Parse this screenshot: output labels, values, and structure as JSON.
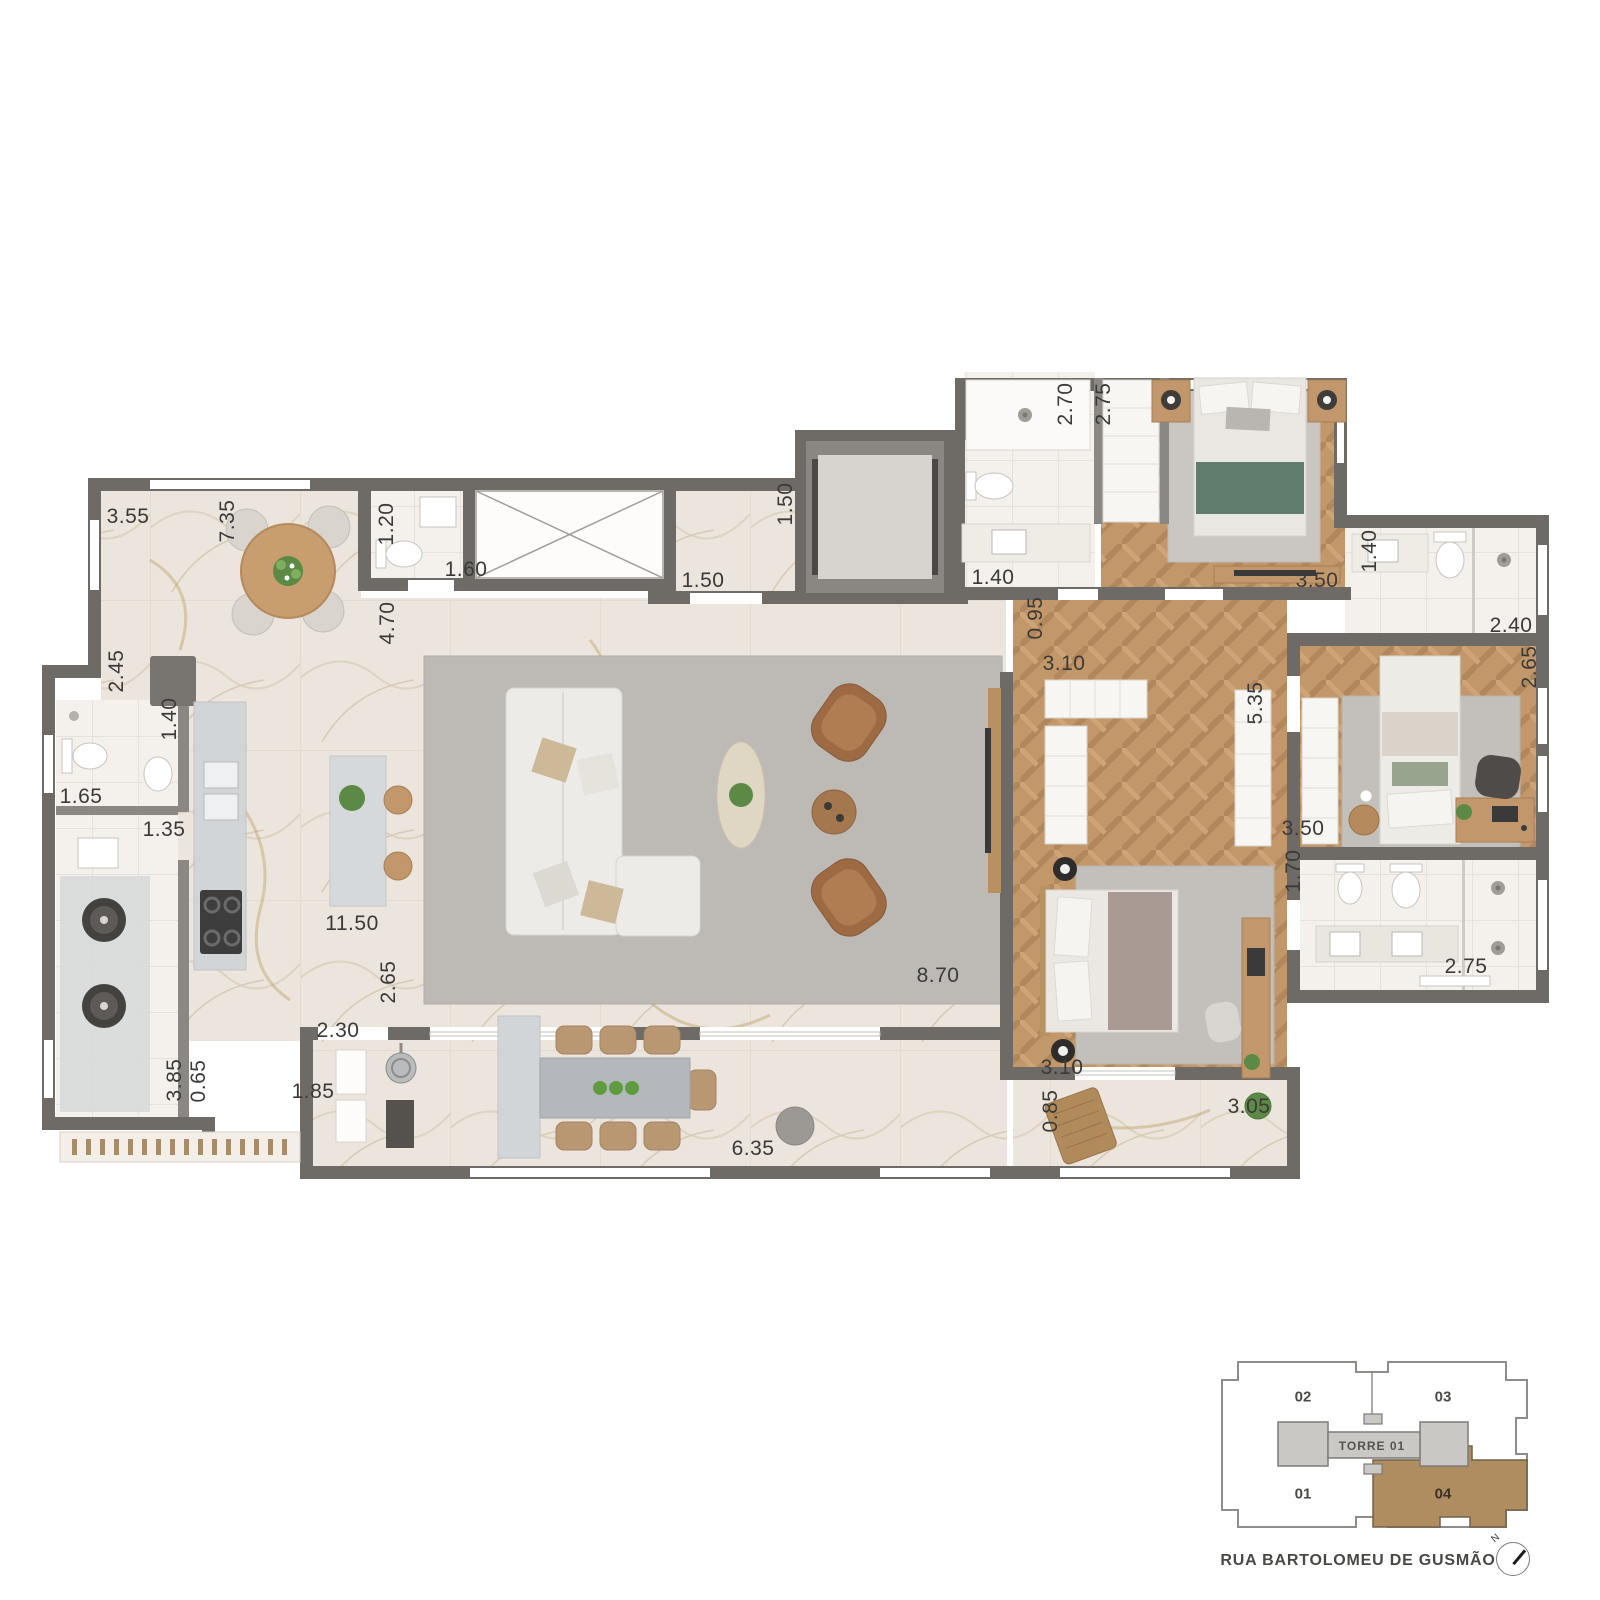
{
  "plan": {
    "street_label": "RUA BARTOLOMEU DE GUSMÃO",
    "compass_label": "N",
    "colors": {
      "wall": "#6e6a66",
      "wood_floor": "#c2976a",
      "marble_floor": "#ebe5dd",
      "white_room": "#f4f1ec",
      "rug": "#bdbab5",
      "keyplan_highlight": "#b08c61",
      "keyplan_core": "#c9c8c4"
    },
    "dimensions": [
      {
        "text": "3.55",
        "x": 128,
        "y": 517,
        "vertical": false
      },
      {
        "text": "7.35",
        "x": 228,
        "y": 521,
        "vertical": true
      },
      {
        "text": "1.20",
        "x": 387,
        "y": 524,
        "vertical": true
      },
      {
        "text": "1.60",
        "x": 466,
        "y": 570,
        "vertical": false
      },
      {
        "text": "4.70",
        "x": 388,
        "y": 623,
        "vertical": true
      },
      {
        "text": "1.50",
        "x": 703,
        "y": 581,
        "vertical": false
      },
      {
        "text": "1.50",
        "x": 786,
        "y": 504,
        "vertical": true
      },
      {
        "text": "1.40",
        "x": 993,
        "y": 578,
        "vertical": false
      },
      {
        "text": "2.70",
        "x": 1066,
        "y": 404,
        "vertical": true
      },
      {
        "text": "2.75",
        "x": 1104,
        "y": 404,
        "vertical": true
      },
      {
        "text": "3.50",
        "x": 1317,
        "y": 581,
        "vertical": false
      },
      {
        "text": "1.40",
        "x": 1370,
        "y": 551,
        "vertical": true
      },
      {
        "text": "2.40",
        "x": 1511,
        "y": 626,
        "vertical": false
      },
      {
        "text": "2.65",
        "x": 1530,
        "y": 667,
        "vertical": true
      },
      {
        "text": "0.95",
        "x": 1036,
        "y": 618,
        "vertical": true
      },
      {
        "text": "3.10",
        "x": 1064,
        "y": 664,
        "vertical": false
      },
      {
        "text": "5.35",
        "x": 1256,
        "y": 703,
        "vertical": true
      },
      {
        "text": "2.45",
        "x": 117,
        "y": 671,
        "vertical": true
      },
      {
        "text": "1.40",
        "x": 170,
        "y": 719,
        "vertical": true
      },
      {
        "text": "1.65",
        "x": 81,
        "y": 797,
        "vertical": false
      },
      {
        "text": "1.35",
        "x": 164,
        "y": 830,
        "vertical": false
      },
      {
        "text": "11.50",
        "x": 352,
        "y": 924,
        "vertical": false
      },
      {
        "text": "2.65",
        "x": 389,
        "y": 982,
        "vertical": true
      },
      {
        "text": "2.30",
        "x": 338,
        "y": 1031,
        "vertical": false
      },
      {
        "text": "3.85",
        "x": 175,
        "y": 1080,
        "vertical": true
      },
      {
        "text": "0.65",
        "x": 199,
        "y": 1081,
        "vertical": true
      },
      {
        "text": "1.85",
        "x": 313,
        "y": 1092,
        "vertical": false
      },
      {
        "text": "6.35",
        "x": 753,
        "y": 1149,
        "vertical": false
      },
      {
        "text": "8.70",
        "x": 938,
        "y": 976,
        "vertical": false
      },
      {
        "text": "3.50",
        "x": 1303,
        "y": 829,
        "vertical": false
      },
      {
        "text": "1.70",
        "x": 1294,
        "y": 871,
        "vertical": true
      },
      {
        "text": "3.10",
        "x": 1062,
        "y": 1068,
        "vertical": false
      },
      {
        "text": "0.85",
        "x": 1051,
        "y": 1111,
        "vertical": true
      },
      {
        "text": "3.05",
        "x": 1249,
        "y": 1107,
        "vertical": false
      },
      {
        "text": "2.75",
        "x": 1466,
        "y": 967,
        "vertical": false
      }
    ],
    "key_plan": {
      "tower_label": "TORRE 01",
      "units": [
        {
          "id": "02",
          "x": 1303,
          "y": 1397,
          "highlighted": false
        },
        {
          "id": "03",
          "x": 1443,
          "y": 1397,
          "highlighted": false
        },
        {
          "id": "01",
          "x": 1303,
          "y": 1494,
          "highlighted": false
        },
        {
          "id": "04",
          "x": 1443,
          "y": 1494,
          "highlighted": true
        }
      ]
    }
  }
}
